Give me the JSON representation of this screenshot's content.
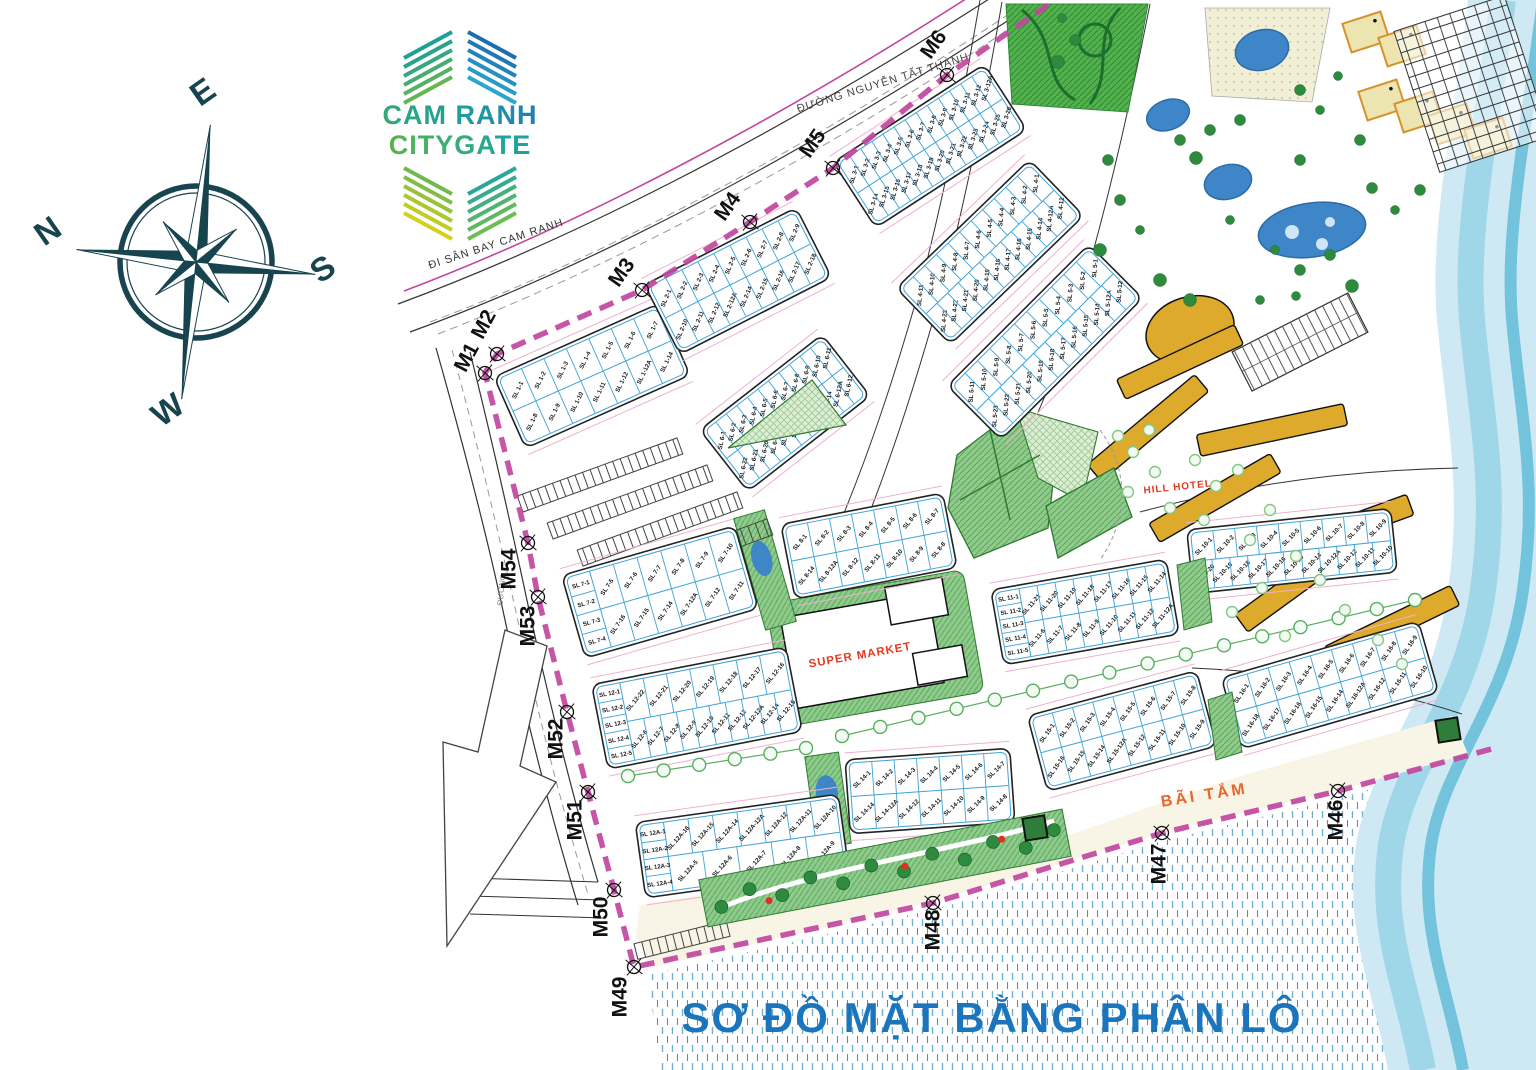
{
  "title": "SƠ ĐỒ MẶT BẰNG PHÂN LÔ",
  "logo": {
    "line1": "CAM RANH",
    "line2": "CITYGATE",
    "fan_colors": {
      "top_left": [
        "#1f9f96",
        "#27a28c",
        "#35a87f",
        "#45ad71",
        "#55b163",
        "#66b656"
      ],
      "top_right": [
        "#1b6fae",
        "#1e79b4",
        "#2184bb",
        "#2590c1",
        "#289bc7",
        "#2ba6cd"
      ],
      "bottom_left": [
        "#6fb94f",
        "#83bd45",
        "#98c23a",
        "#adc72f",
        "#c1cb25",
        "#d4d01b"
      ],
      "bottom_right": [
        "#2aa79b",
        "#37ab8d",
        "#45b07e",
        "#52b470",
        "#60b961",
        "#6dbd53"
      ]
    }
  },
  "compass": {
    "n": "N",
    "e": "E",
    "s": "S",
    "w": "W"
  },
  "roads": {
    "airport_road": "ĐI SÂN BAY CAM RANH",
    "main_road": "ĐƯỜNG NGUYỄN TẤT THÀNH",
    "west_road": "ĐƯỜNG"
  },
  "landmarks": {
    "supermarket": "SUPER MARKET",
    "hill_hotel": "HILL HOTEL",
    "beach": "BÃI TẮM"
  },
  "colors": {
    "boundary": "#c2479f",
    "plot_stroke": "#3fa3d8",
    "block_stroke": "#222222",
    "green_fill": "#8fcb8b",
    "green_dark": "#2f7a33",
    "pool": "#3f86c8",
    "gold": "#deaa2b",
    "sea_fill": "#cfe9f4",
    "sea_band1": "#9fd6e8",
    "sea_band2": "#72c3db",
    "title_blue": "#1b75bc",
    "red_label": "#e2391f",
    "orange_label": "#e8652c",
    "compass": "#17444e",
    "beach_sand": "#f9f5e6",
    "water_dash": "#5fa8cf"
  },
  "map": {
    "boundary_start": [
      1048,
      5
    ],
    "boundary_end": [
      1495,
      748
    ],
    "markers": [
      {
        "id": "M6",
        "x": 947,
        "y": 75,
        "lx": 933,
        "ly": 44,
        "rot": -55
      },
      {
        "id": "M5",
        "x": 833,
        "y": 168,
        "lx": 812,
        "ly": 143,
        "rot": -55
      },
      {
        "id": "M4",
        "x": 750,
        "y": 222,
        "lx": 727,
        "ly": 206,
        "rot": -55
      },
      {
        "id": "M3",
        "x": 642,
        "y": 290,
        "lx": 621,
        "ly": 272,
        "rot": -55
      },
      {
        "id": "M2",
        "x": 497,
        "y": 354,
        "lx": 483,
        "ly": 324,
        "rot": -62
      },
      {
        "id": "M1",
        "x": 485,
        "y": 373,
        "lx": 466,
        "ly": 357,
        "rot": -62
      },
      {
        "id": "M54",
        "x": 528,
        "y": 543,
        "lx": 508,
        "ly": 569,
        "rot": -90
      },
      {
        "id": "M53",
        "x": 538,
        "y": 597,
        "lx": 527,
        "ly": 626,
        "rot": -90
      },
      {
        "id": "M52",
        "x": 567,
        "y": 712,
        "lx": 555,
        "ly": 739,
        "rot": -90
      },
      {
        "id": "M51",
        "x": 588,
        "y": 792,
        "lx": 574,
        "ly": 820,
        "rot": -90
      },
      {
        "id": "M50",
        "x": 614,
        "y": 890,
        "lx": 600,
        "ly": 917,
        "rot": -90
      },
      {
        "id": "M49",
        "x": 634,
        "y": 967,
        "lx": 619,
        "ly": 997,
        "rot": -90
      },
      {
        "id": "M48",
        "x": 933,
        "y": 903,
        "lx": 932,
        "ly": 930,
        "rot": -90
      },
      {
        "id": "M47",
        "x": 1162,
        "y": 833,
        "lx": 1158,
        "ly": 864,
        "rot": -90
      },
      {
        "id": "M46",
        "x": 1338,
        "y": 791,
        "lx": 1335,
        "ly": 820,
        "rot": -90
      }
    ],
    "blocks": [
      {
        "name": "SL 1",
        "cx": 592,
        "cy": 376,
        "w": 180,
        "h": 78,
        "rot": -24,
        "rows": [
          [
            "SL 1-1",
            "SL 1-2",
            "SL 1-3",
            "SL 1-4",
            "SL 1-5",
            "SL 1-6",
            "SL 1-7"
          ],
          [
            "SL 1-8",
            "SL 1-9",
            "SL 1-10",
            "SL 1-11",
            "SL 1-12",
            "SL 1-12A",
            "SL 1-14"
          ]
        ]
      },
      {
        "name": "SL 2",
        "cx": 738,
        "cy": 281,
        "w": 170,
        "h": 78,
        "rot": -27,
        "rows": [
          [
            "SL 2-1",
            "SL 2-2",
            "SL 2-3",
            "SL 2-4",
            "SL 2-5",
            "SL 2-6",
            "SL 2-7",
            "SL 2-8",
            "SL 2-9"
          ],
          [
            "SL 2-10",
            "SL 2-11",
            "SL 2-12",
            "SL 2-12A",
            "SL 2-14",
            "SL 2-15",
            "SL 2-16",
            "SL 2-17",
            "SL 2-18"
          ]
        ]
      },
      {
        "name": "SL 3",
        "cx": 930,
        "cy": 146,
        "w": 180,
        "h": 78,
        "rot": -33,
        "rows": [
          [
            "SL 3-1",
            "SL 3-2",
            "SL 3-3",
            "SL 3-4",
            "SL 3-5",
            "SL 3-6",
            "SL 3-7",
            "SL 3-8",
            "SL 3-9",
            "SL 3-10",
            "SL 3-11",
            "SL 3-12",
            "SL 3-12A"
          ],
          [
            "SL 3-14",
            "SL 3-15",
            "SL 3-16",
            "SL 3-17",
            "SL 3-18",
            "SL 3-19",
            "SL 3-20",
            "SL 3-21",
            "SL 3-22",
            "SL 3-23",
            "SL 3-24",
            "SL 3-25",
            "SL 3-26"
          ]
        ]
      },
      {
        "name": "SL 4",
        "cx": 990,
        "cy": 252,
        "w": 185,
        "h": 78,
        "rot": -44,
        "rows": [
          [
            "SL 4-11",
            "SL 4-10",
            "SL 4-9",
            "SL 4-8",
            "SL 4-7",
            "SL 4-6",
            "SL 4-5",
            "SL 4-4",
            "SL 4-3",
            "SL 4-2",
            "SL 4-1"
          ],
          [
            "SL 4-23",
            "SL 4-22",
            "SL 4-21",
            "SL 4-20",
            "SL 4-19",
            "SL 4-18",
            "SL 4-17",
            "SL 4-16",
            "SL 4-15",
            "SL 4-14",
            "SL 4-12A",
            "SL 4-12"
          ]
        ]
      },
      {
        "name": "SL 5",
        "cx": 1045,
        "cy": 342,
        "w": 200,
        "h": 76,
        "rot": -45,
        "rows": [
          [
            "SL 5-11",
            "SL 5-10",
            "SL 5-9",
            "SL 5-8",
            "SL 5-7",
            "SL 5-6",
            "SL 5-5",
            "SL 5-4",
            "SL 5-3",
            "SL 5-2",
            "SL 5-1"
          ],
          [
            "SL 5-23",
            "SL 5-22",
            "SL 5-21",
            "SL 5-20",
            "SL 5-19",
            "SL 5-18",
            "SL 5-17",
            "SL 5-16",
            "SL 5-15",
            "SL 5-14",
            "SL 5-12A",
            "SL 5-12"
          ]
        ]
      },
      {
        "name": "SL 6",
        "cx": 785,
        "cy": 413,
        "w": 155,
        "h": 78,
        "rot": -38,
        "rows": [
          [
            "SL 6-1",
            "SL 6-2",
            "SL 6-3",
            "SL 6-4",
            "SL 6-5",
            "SL 6-6",
            "SL 6-7",
            "SL 6-8",
            "SL 6-9",
            "SL 6-10",
            "SL 6-11"
          ],
          [
            "SL 6-22",
            "SL 6-21",
            "SL 6-20",
            "SL 6-19",
            "SL 6-18",
            "SL 6-17",
            "SL 6-16",
            "SL 6-15",
            "SL 6-14",
            "SL 6-12A",
            "SL 6-12"
          ]
        ]
      },
      {
        "name": "SL 7",
        "cx": 660,
        "cy": 592,
        "w": 180,
        "h": 86,
        "rot": -16,
        "leftcol": [
          "SL 7-1",
          "SL 7-2",
          "SL 7-3",
          "SL 7-4"
        ],
        "rows": [
          [
            "SL 7-5",
            "SL 7-6",
            "SL 7-7",
            "SL 7-8",
            "SL 7-9",
            "SL 7-10"
          ],
          [
            "SL 7-16",
            "SL 7-15",
            "SL 7-14",
            "SL 7-12A",
            "SL 7-12",
            "SL 7-11"
          ]
        ]
      },
      {
        "name": "SL 8",
        "cx": 869,
        "cy": 546,
        "w": 165,
        "h": 76,
        "rot": -11,
        "rows": [
          [
            "SL 8-1",
            "SL 8-2",
            "SL 8-3",
            "SL 8-4",
            "SL 8-5",
            "SL 8-6",
            "SL 8-7"
          ],
          [
            "SL 8-14",
            "SL 8-12A",
            "SL 8-12",
            "SL 8-11",
            "SL 8-10",
            "SL 8-9",
            "SL 8-8"
          ]
        ]
      },
      {
        "name": "SL 10",
        "cx": 1292,
        "cy": 551,
        "w": 205,
        "h": 64,
        "rot": -6,
        "rows": [
          [
            "SL 10-1",
            "SL 10-2",
            "SL 10-3",
            "SL 10-4",
            "SL 10-5",
            "SL 10-6",
            "SL 10-7",
            "SL 10-8",
            "SL 10-9"
          ],
          [
            "SL 10-20",
            "SL 10-19",
            "SL 10-18",
            "SL 10-17",
            "SL 10-16",
            "SL 10-15",
            "SL 10-14",
            "SL 10-12A",
            "SL 10-12",
            "SL 10-11",
            "SL 10-10"
          ]
        ]
      },
      {
        "name": "SL 11",
        "cx": 1085,
        "cy": 612,
        "w": 178,
        "h": 76,
        "rot": -10,
        "leftcol": [
          "SL 11-1",
          "SL 11-2",
          "SL 11-3",
          "SL 11-4",
          "SL 11-5"
        ],
        "rows": [
          [
            "SL 11-21",
            "SL 11-20",
            "SL 11-19",
            "SL 11-18",
            "SL 11-17",
            "SL 11-16",
            "SL 11-15",
            "SL 11-14"
          ],
          [
            "SL 11-6",
            "SL 11-7",
            "SL 11-8",
            "SL 11-9",
            "SL 11-10",
            "SL 11-11",
            "SL 11-12",
            "SL 11-12A"
          ]
        ]
      },
      {
        "name": "SL 12",
        "cx": 697,
        "cy": 708,
        "w": 198,
        "h": 86,
        "rot": -11,
        "leftcol": [
          "SL 12-1",
          "SL 12-2",
          "SL 12-3",
          "SL 12-4",
          "SL 12-5"
        ],
        "rows": [
          [
            "SL 12-22",
            "SL 12-21",
            "SL 12-20",
            "SL 12-19",
            "SL 12-18",
            "SL 12-17",
            "SL 12-16"
          ],
          [
            "SL 12-6",
            "SL 12-7",
            "SL 12-8",
            "SL 12-9",
            "SL 12-10",
            "SL 12-11",
            "SL 12-12",
            "SL 12-12A",
            "SL 12-14",
            "SL 12-15"
          ]
        ]
      },
      {
        "name": "SL 12A",
        "cx": 742,
        "cy": 846,
        "w": 205,
        "h": 76,
        "rot": -8,
        "leftcol": [
          "SL 12A-1",
          "SL 12A-2",
          "SL 12A-3",
          "SL 12A-4"
        ],
        "rows": [
          [
            "SL 12A-16",
            "SL 12A-15",
            "SL 12A-14",
            "SL 12A-12A",
            "SL 12A-12",
            "SL 12A-11",
            "SL 12A-10"
          ],
          [
            "SL 12A-5",
            "SL 12A-6",
            "SL 12A-7",
            "SL 12A-8",
            "SL 12A-9"
          ]
        ]
      },
      {
        "name": "SL 14",
        "cx": 930,
        "cy": 791,
        "w": 165,
        "h": 74,
        "rot": -4,
        "rows": [
          [
            "SL 14-1",
            "SL 14-2",
            "SL 14-3",
            "SL 14-4",
            "SL 14-5",
            "SL 14-6",
            "SL 14-7"
          ],
          [
            "SL 14-14",
            "SL 14-12A",
            "SL 14-12",
            "SL 14-11",
            "SL 14-10",
            "SL 14-9",
            "SL 14-8"
          ]
        ]
      },
      {
        "name": "SL 15",
        "cx": 1122,
        "cy": 731,
        "w": 175,
        "h": 78,
        "rot": -15,
        "rows": [
          [
            "SL 15-1",
            "SL 15-2",
            "SL 15-3",
            "SL 15-4",
            "SL 15-5",
            "SL 15-6",
            "SL 15-7",
            "SL 15-8"
          ],
          [
            "SL 15-16",
            "SL 15-15",
            "SL 15-14",
            "SL 15-12A",
            "SL 15-12",
            "SL 15-11",
            "SL 15-10",
            "SL 15-9"
          ]
        ]
      },
      {
        "name": "SL 16",
        "cx": 1330,
        "cy": 685,
        "w": 205,
        "h": 74,
        "rot": -16,
        "rows": [
          [
            "SL 16-1",
            "SL 16-2",
            "SL 16-3",
            "SL 16-4",
            "SL 16-5",
            "SL 16-6",
            "SL 16-7",
            "SL 16-8",
            "SL 16-9"
          ],
          [
            "SL 16-18",
            "SL 16-17",
            "SL 16-16",
            "SL 16-15",
            "SL 16-14",
            "SL 16-12A",
            "SL 16-12",
            "SL 16-11",
            "SL 16-10"
          ]
        ]
      }
    ]
  }
}
